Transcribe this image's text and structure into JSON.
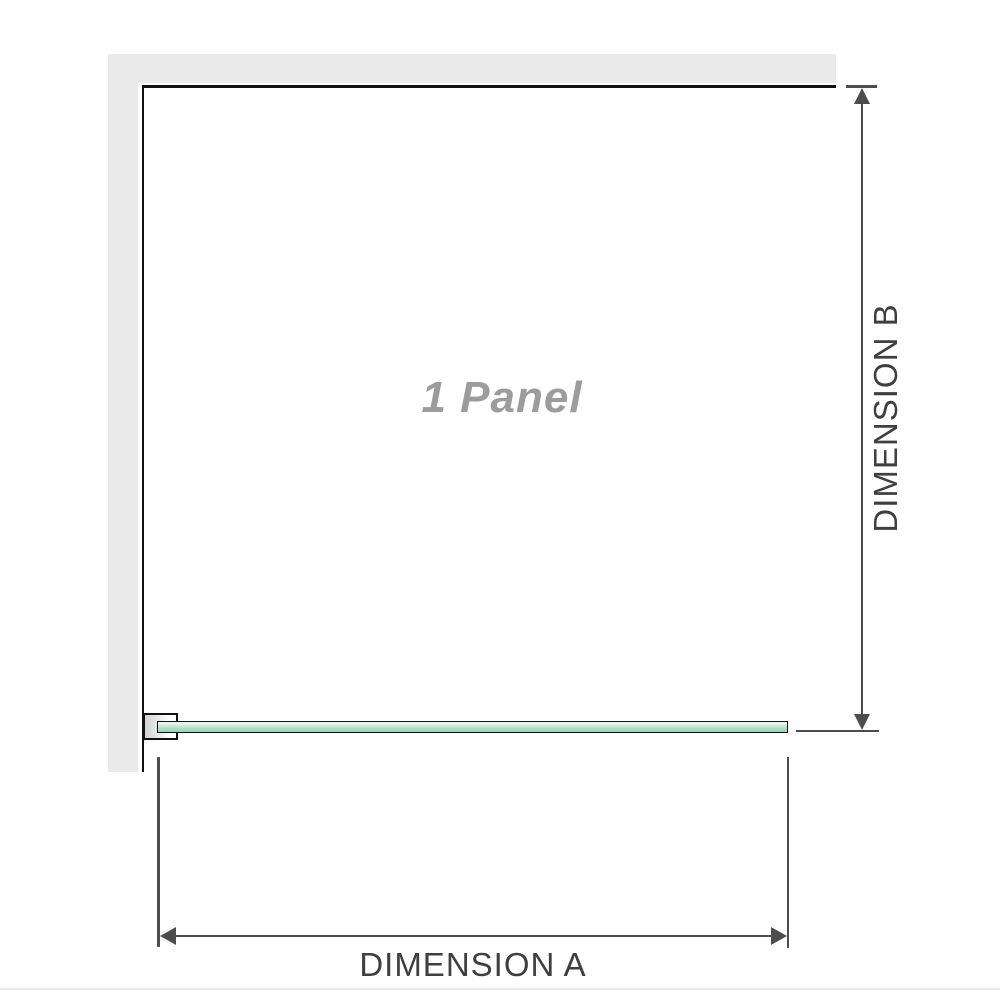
{
  "diagram": {
    "watermark_label": "1 Panel",
    "dimension_a_label": "DIMENSION A",
    "dimension_b_label": "DIMENSION B"
  },
  "colors": {
    "wall": "#eaeaea",
    "panel_border": "#111111",
    "glass_gradient_top": "#f2faf5",
    "glass_gradient_bottom": "#98d5b0",
    "dimension_line": "#4d4d4d",
    "label_text": "#3f3f3f",
    "watermark_text": "#9c9c9c",
    "footer_line": "#e8e8e8"
  }
}
